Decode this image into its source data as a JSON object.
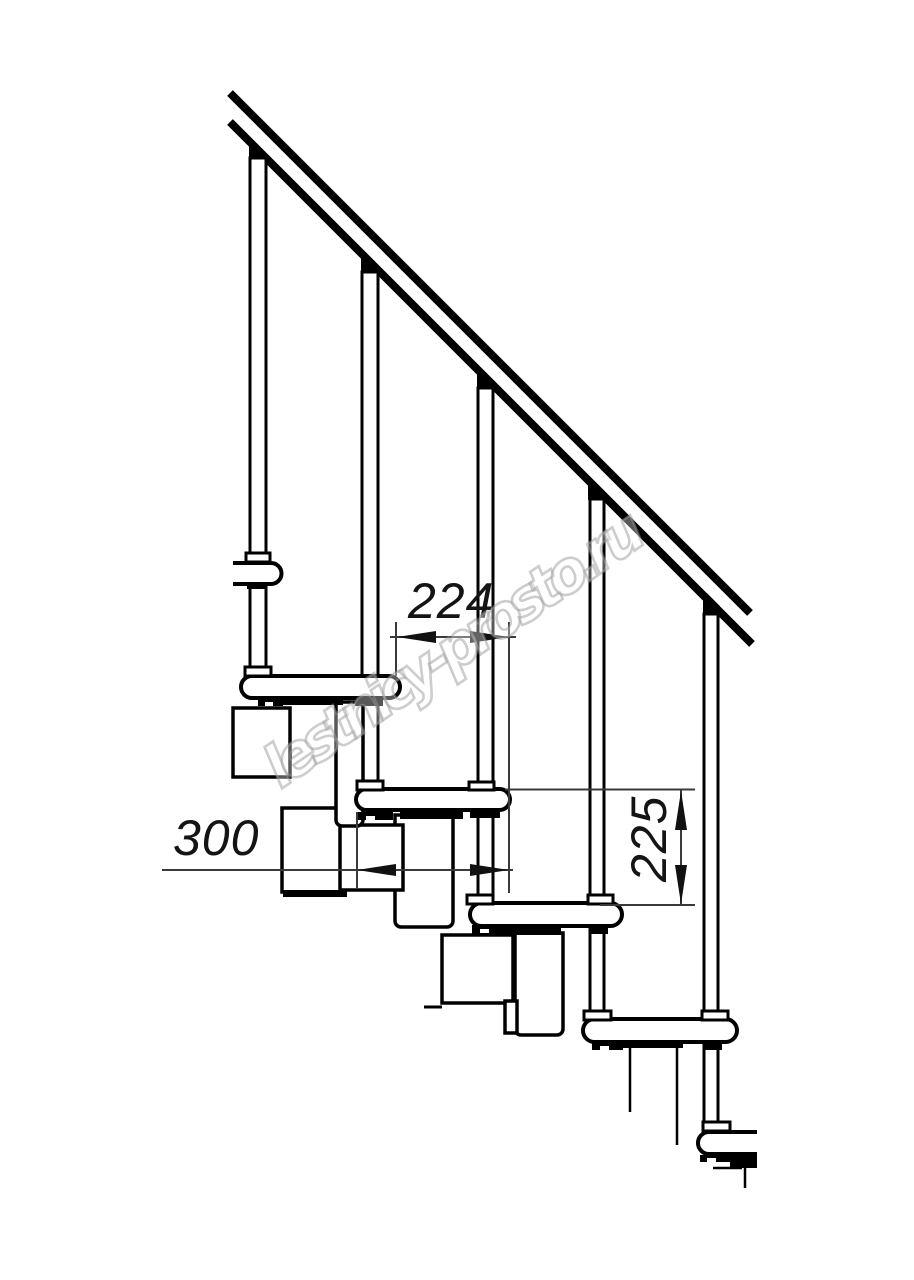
{
  "drawing": {
    "kind": "staircase side elevation, black line technical drawing on white",
    "line_color": "#000000",
    "dim_color": "#141414",
    "background": "#ffffff",
    "balusters_count": 5,
    "treads_count": 6,
    "handrail": "diagonal handrail band, upper-left to lower-right, 45 degrees"
  },
  "dimensions": {
    "going": {
      "value": "224",
      "orientation": "horizontal",
      "location": "between baluster bases of treads 2 and 3"
    },
    "tread_depth": {
      "value": "300",
      "orientation": "horizontal",
      "location": "lower left, through support module"
    },
    "riser_height": {
      "value": "225",
      "orientation": "vertical",
      "location": "right side, between tread 3 and tread 4 levels"
    }
  },
  "watermark": {
    "text": "lestnicy-prosto.ru",
    "color": "#9b9b9b",
    "style": "hollow outline, rotated diagonal"
  }
}
